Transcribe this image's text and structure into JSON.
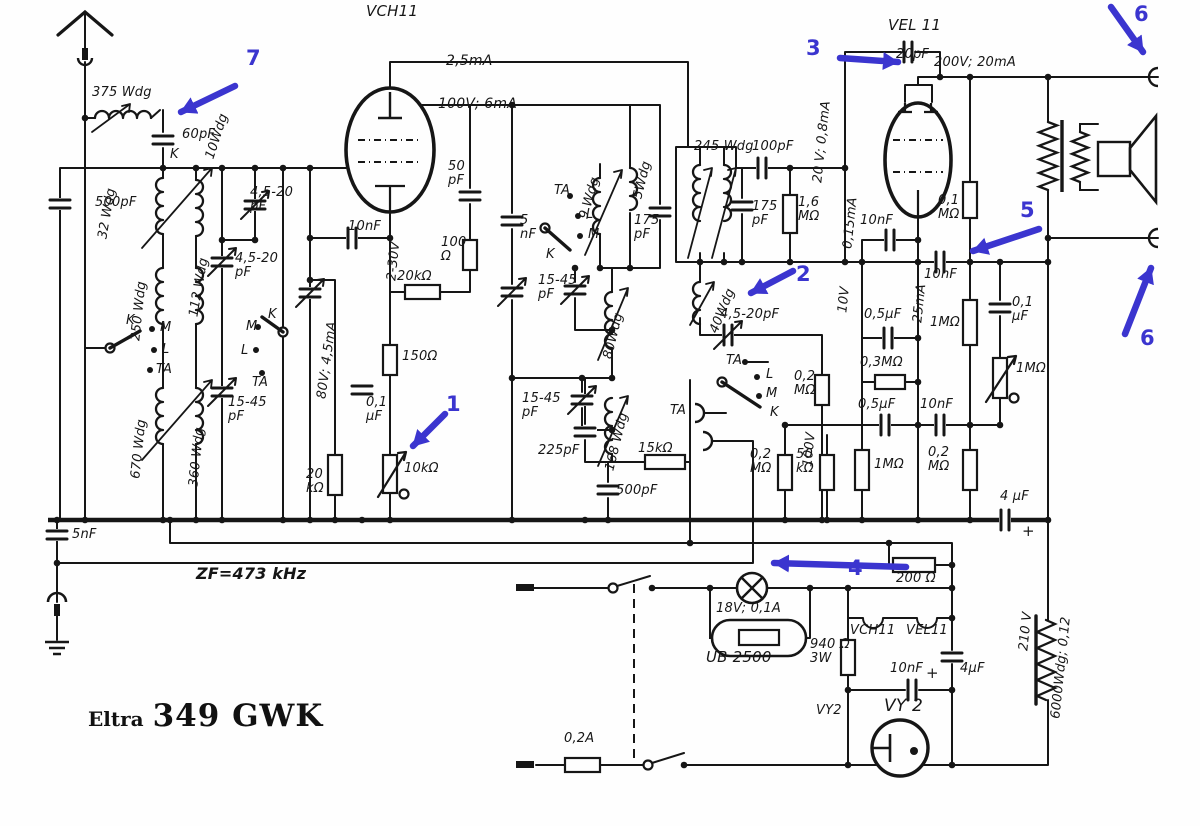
{
  "meta": {
    "brand": "Eltra",
    "model": "349 GWK",
    "schematic_type": "radio receiver schematic"
  },
  "colors": {
    "ink": "#161616",
    "annotation_blue": "#3b35cf",
    "paper": "#fefefe"
  },
  "tubes": {
    "mixer": "VCH11",
    "output": "VEL 11",
    "rectifier": "VY 2",
    "ballast": "UB 2500"
  },
  "if_frequency": "ZF=473 kHz",
  "annotations": {
    "a1": "1",
    "a2": "2",
    "a3": "3",
    "a4": "4",
    "a5": "5",
    "a6_top": "6",
    "a6_bottom": "6",
    "a7": "7"
  },
  "labels": [
    {
      "t": "375 Wdg",
      "x": 92,
      "y": 86
    },
    {
      "t": "60pF",
      "x": 182,
      "y": 128
    },
    {
      "t": "10Wdg",
      "x": 210,
      "y": 152,
      "r": -72
    },
    {
      "t": "K",
      "x": 170,
      "y": 148
    },
    {
      "t": "500pF",
      "x": 95,
      "y": 196
    },
    {
      "t": "32 Wdg",
      "x": 103,
      "y": 232,
      "r": -80
    },
    {
      "t": "4,5-20\npF",
      "x": 250,
      "y": 186
    },
    {
      "t": "112 Wdg",
      "x": 194,
      "y": 310,
      "r": -80
    },
    {
      "t": "4,5-20\npF",
      "x": 235,
      "y": 252
    },
    {
      "t": "250 Wdg",
      "x": 136,
      "y": 334,
      "r": -84
    },
    {
      "t": "K",
      "x": 126,
      "y": 314
    },
    {
      "t": "M",
      "x": 160,
      "y": 321
    },
    {
      "t": "L",
      "x": 162,
      "y": 343
    },
    {
      "t": "TA",
      "x": 156,
      "y": 363
    },
    {
      "t": "670 Wdg",
      "x": 136,
      "y": 472,
      "r": -84
    },
    {
      "t": "360 Wdg",
      "x": 194,
      "y": 480,
      "r": -84
    },
    {
      "t": "15-45\npF",
      "x": 228,
      "y": 396
    },
    {
      "t": "M",
      "x": 246,
      "y": 320
    },
    {
      "t": "K",
      "x": 268,
      "y": 308
    },
    {
      "t": "L",
      "x": 241,
      "y": 344
    },
    {
      "t": "TA",
      "x": 252,
      "y": 376
    },
    {
      "t": "VCH11",
      "x": 366,
      "y": 4,
      "fs": 15
    },
    {
      "t": "2,5mA",
      "x": 446,
      "y": 54,
      "fs": 14
    },
    {
      "t": "100V; 6mA",
      "x": 438,
      "y": 97,
      "fs": 14
    },
    {
      "t": "50\npF",
      "x": 448,
      "y": 160
    },
    {
      "t": "5\nnF",
      "x": 520,
      "y": 214
    },
    {
      "t": "10nF",
      "x": 348,
      "y": 220
    },
    {
      "t": "2-30V",
      "x": 392,
      "y": 274,
      "r": -84
    },
    {
      "t": "20kΩ",
      "x": 397,
      "y": 270
    },
    {
      "t": "100\nΩ",
      "x": 441,
      "y": 236
    },
    {
      "t": "80V; 4,5mA",
      "x": 322,
      "y": 392,
      "r": -82
    },
    {
      "t": "150Ω",
      "x": 402,
      "y": 350
    },
    {
      "t": "0,1\nµF",
      "x": 366,
      "y": 396
    },
    {
      "t": "10kΩ",
      "x": 404,
      "y": 462
    },
    {
      "t": "20\nkΩ",
      "x": 306,
      "y": 468
    },
    {
      "t": "TA",
      "x": 554,
      "y": 184
    },
    {
      "t": "L",
      "x": 586,
      "y": 208
    },
    {
      "t": "M",
      "x": 588,
      "y": 228
    },
    {
      "t": "K",
      "x": 546,
      "y": 248
    },
    {
      "t": "9 Wdg",
      "x": 584,
      "y": 212,
      "r": -74
    },
    {
      "t": "5Wdg",
      "x": 638,
      "y": 192,
      "r": -76
    },
    {
      "t": "175\npF",
      "x": 634,
      "y": 214
    },
    {
      "t": "15-45\npF",
      "x": 538,
      "y": 274
    },
    {
      "t": "80Wdg",
      "x": 608,
      "y": 352,
      "r": -76
    },
    {
      "t": "15-45\npF",
      "x": 522,
      "y": 392
    },
    {
      "t": "168 Wdg",
      "x": 610,
      "y": 464,
      "r": -76
    },
    {
      "t": "225pF",
      "x": 538,
      "y": 444
    },
    {
      "t": "15kΩ",
      "x": 638,
      "y": 442
    },
    {
      "t": "500pF",
      "x": 616,
      "y": 484
    },
    {
      "t": "245 Wdg",
      "x": 694,
      "y": 140
    },
    {
      "t": "100pF",
      "x": 752,
      "y": 140
    },
    {
      "t": "175\npF",
      "x": 752,
      "y": 200
    },
    {
      "t": "1,6\nMΩ",
      "x": 798,
      "y": 196
    },
    {
      "t": "20 V; 0,8mA",
      "x": 818,
      "y": 176,
      "r": -84
    },
    {
      "t": "0,15mA",
      "x": 848,
      "y": 242,
      "r": -84
    },
    {
      "t": "10nF",
      "x": 860,
      "y": 214
    },
    {
      "t": "VEL 11",
      "x": 888,
      "y": 18,
      "fs": 15
    },
    {
      "t": "20pF",
      "x": 896,
      "y": 48
    },
    {
      "t": "200V; 20mA",
      "x": 934,
      "y": 56
    },
    {
      "t": "0,1\nMΩ",
      "x": 938,
      "y": 194
    },
    {
      "t": "40Wdg",
      "x": 714,
      "y": 326,
      "r": -68
    },
    {
      "t": "4,5-20pF",
      "x": 720,
      "y": 308
    },
    {
      "t": "TA",
      "x": 726,
      "y": 354
    },
    {
      "t": "L",
      "x": 766,
      "y": 368
    },
    {
      "t": "M",
      "x": 766,
      "y": 387
    },
    {
      "t": "K",
      "x": 770,
      "y": 406
    },
    {
      "t": "TA",
      "x": 670,
      "y": 404
    },
    {
      "t": "0,2\nMΩ",
      "x": 794,
      "y": 370
    },
    {
      "t": "10V",
      "x": 843,
      "y": 306,
      "r": -84
    },
    {
      "t": "25mA",
      "x": 918,
      "y": 316,
      "r": -84
    },
    {
      "t": "10nF",
      "x": 924,
      "y": 268
    },
    {
      "t": "0,5µF",
      "x": 864,
      "y": 308
    },
    {
      "t": "1MΩ",
      "x": 930,
      "y": 316
    },
    {
      "t": "0,1\nµF",
      "x": 1012,
      "y": 296
    },
    {
      "t": "0,3MΩ",
      "x": 860,
      "y": 356
    },
    {
      "t": "1MΩ",
      "x": 1016,
      "y": 362
    },
    {
      "t": "0,5µF",
      "x": 858,
      "y": 398
    },
    {
      "t": "10nF",
      "x": 920,
      "y": 398
    },
    {
      "t": "1MΩ",
      "x": 874,
      "y": 458
    },
    {
      "t": "0,2\nMΩ",
      "x": 928,
      "y": 446
    },
    {
      "t": "0,2\nMΩ",
      "x": 750,
      "y": 448
    },
    {
      "t": "50\nkΩ",
      "x": 796,
      "y": 448
    },
    {
      "t": "100V",
      "x": 808,
      "y": 460,
      "r": -84
    },
    {
      "t": "4 µF",
      "x": 1000,
      "y": 490
    },
    {
      "t": "+",
      "x": 1022,
      "y": 524,
      "fs": 15
    },
    {
      "t": "ZF=473 kHz",
      "x": 196,
      "y": 566,
      "fs": 16,
      "w": "600"
    },
    {
      "t": "5nF",
      "x": 72,
      "y": 528
    },
    {
      "t": "200 Ω",
      "x": 896,
      "y": 572
    },
    {
      "t": "18V; 0,1A",
      "x": 716,
      "y": 602
    },
    {
      "t": "UB 2500",
      "x": 706,
      "y": 650,
      "fs": 15
    },
    {
      "t": "VCH11",
      "x": 850,
      "y": 624
    },
    {
      "t": "VEL11",
      "x": 906,
      "y": 624
    },
    {
      "t": "940 Ω\n3W",
      "x": 810,
      "y": 638
    },
    {
      "t": "VY2",
      "x": 816,
      "y": 704
    },
    {
      "t": "VY 2",
      "x": 884,
      "y": 698,
      "fs": 17
    },
    {
      "t": "10nF",
      "x": 890,
      "y": 662
    },
    {
      "t": "+",
      "x": 926,
      "y": 666,
      "fs": 15
    },
    {
      "t": "4µF",
      "x": 960,
      "y": 662
    },
    {
      "t": "210 V",
      "x": 1024,
      "y": 644,
      "r": -84
    },
    {
      "t": "6000Wdg; 0,12",
      "x": 1056,
      "y": 712,
      "r": -84
    },
    {
      "t": "0,2A",
      "x": 564,
      "y": 732
    }
  ]
}
